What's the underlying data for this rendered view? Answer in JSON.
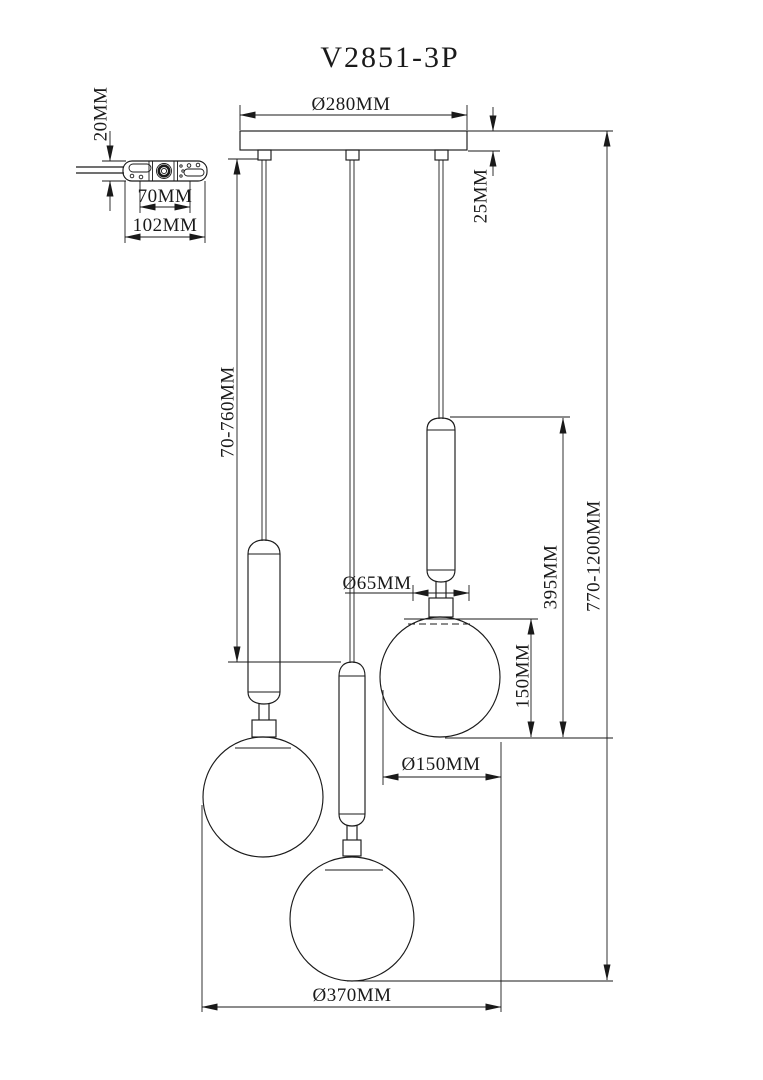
{
  "title": "V2851-3P",
  "colors": {
    "line": "#1a1a1a",
    "background": "#ffffff"
  },
  "side_view": {
    "thickness_label": "20MM",
    "hole_spacing_label": "70MM",
    "length_label": "102MM"
  },
  "front_view": {
    "canopy_diameter_label": "Ø280MM",
    "canopy_height_label": "25MM",
    "cord_length_label": "70-760MM",
    "overall_height_label": "770-1200MM",
    "stem_top_diameter_label": "Ø65MM",
    "pendant_drop_label": "395MM",
    "globe_height_label": "150MM",
    "globe_diameter_label": "Ø150MM",
    "overall_width_label": "Ø370MM"
  }
}
